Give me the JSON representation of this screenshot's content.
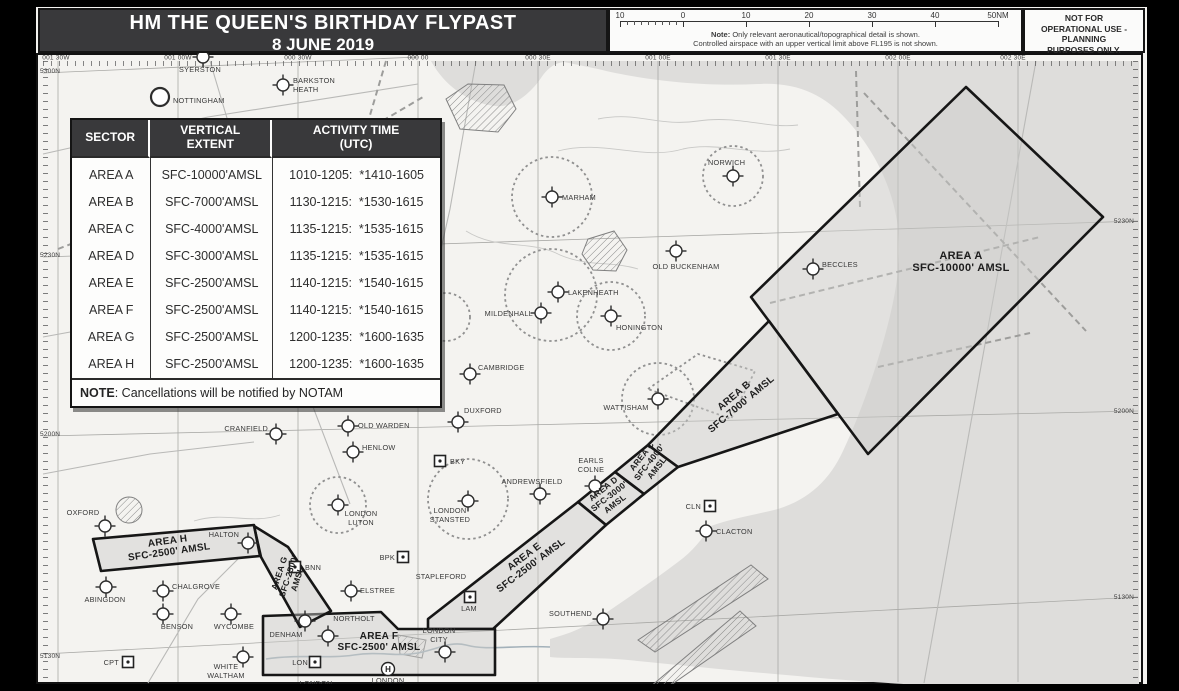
{
  "header": {
    "title_line1": "HM THE QUEEN'S BIRTHDAY FLYPAST",
    "title_line2": "8 JUNE 2019",
    "scale_ticks": [
      "10",
      "0",
      "10",
      "20",
      "30",
      "40",
      "50NM"
    ],
    "scale_note_label": "Note:",
    "scale_note_line1": "Only relevant aeronautical/topographical detail is shown.",
    "scale_note_line2": "Controlled airspace with an upper vertical limit above FL195 is not shown.",
    "disclaimer": "NOT FOR\nOPERATIONAL USE -\nPLANNING\nPURPOSES ONLY."
  },
  "activity_table": {
    "col_headers": [
      "SECTOR",
      "VERTICAL\nEXTENT",
      "ACTIVITY TIME\n(UTC)"
    ],
    "rows": [
      [
        "AREA A",
        "SFC-10000'AMSL",
        "1010-1205:  *1410-1605"
      ],
      [
        "AREA B",
        "SFC-7000'AMSL",
        "1130-1215:  *1530-1615"
      ],
      [
        "AREA C",
        "SFC-4000'AMSL",
        "1135-1215:  *1535-1615"
      ],
      [
        "AREA D",
        "SFC-3000'AMSL",
        "1135-1215:  *1535-1615"
      ],
      [
        "AREA E",
        "SFC-2500'AMSL",
        "1140-1215:  *1540-1615"
      ],
      [
        "AREA F",
        "SFC-2500'AMSL",
        "1140-1215:  *1540-1615"
      ],
      [
        "AREA G",
        "SFC-2500'AMSL",
        "1200-1235:  *1600-1635"
      ],
      [
        "AREA H",
        "SFC-2500'AMSL",
        "1200-1235:  *1600-1635"
      ]
    ],
    "note_bold": "NOTE",
    "note_rest": ": Cancellations will be notified by NOTAM"
  },
  "map": {
    "edge_labels": {
      "top": [
        {
          "text": "001 30W",
          "x": 58
        },
        {
          "text": "001 00W",
          "x": 180
        },
        {
          "text": "000 30W",
          "x": 300
        },
        {
          "text": "000 00",
          "x": 420
        },
        {
          "text": "000 30E",
          "x": 540
        },
        {
          "text": "001 00E",
          "x": 660
        },
        {
          "text": "001 30E",
          "x": 780
        },
        {
          "text": "002 00E",
          "x": 900
        },
        {
          "text": "002 30E",
          "x": 1015
        }
      ],
      "left": [
        {
          "text": "5300N",
          "y": 74
        },
        {
          "text": "5230N",
          "y": 258
        },
        {
          "text": "5200N",
          "y": 437
        },
        {
          "text": "5130N",
          "y": 659
        }
      ],
      "right": [
        {
          "text": "5230N",
          "y": 224
        },
        {
          "text": "5200N",
          "y": 414
        },
        {
          "text": "5130N",
          "y": 600
        }
      ]
    },
    "areas": [
      {
        "id": "area-a",
        "lines": [
          "AREA A",
          "SFC-10000' AMSL"
        ],
        "x": 963,
        "y": 260,
        "rot": 0,
        "fs": 11
      },
      {
        "id": "area-b",
        "lines": [
          "AREA B",
          "SFC-7000' AMSL"
        ],
        "x": 738,
        "y": 399,
        "rot": -40,
        "fs": 10
      },
      {
        "id": "area-c",
        "lines": [
          "AREA C",
          "SFC-4000'",
          "AMSL"
        ],
        "x": 646,
        "y": 459,
        "rot": -52,
        "fs": 8.5
      },
      {
        "id": "area-d",
        "lines": [
          "AREA D",
          "SFC-3000'",
          "AMSL"
        ],
        "x": 607,
        "y": 492,
        "rot": -38,
        "fs": 8.5
      },
      {
        "id": "area-e",
        "lines": [
          "AREA E",
          "SFC-2500' AMSL"
        ],
        "x": 528,
        "y": 560,
        "rot": -37,
        "fs": 10
      },
      {
        "id": "area-f",
        "lines": [
          "AREA F",
          "SFC-2500' AMSL"
        ],
        "x": 381,
        "y": 640,
        "rot": 0,
        "fs": 10
      },
      {
        "id": "area-g",
        "lines": [
          "AREA G",
          "SFC-2500'",
          "AMSL"
        ],
        "x": 284,
        "y": 575,
        "rot": -72,
        "fs": 8.5
      },
      {
        "id": "area-h",
        "lines": [
          "AREA H",
          "SFC-2500' AMSL"
        ],
        "x": 170,
        "y": 545,
        "rot": -8,
        "fs": 10
      }
    ],
    "places": [
      {
        "name": "SYERSTON",
        "sym": "airfield",
        "sx": 205,
        "sy": 58,
        "label": [
          "SYERSTON"
        ],
        "lx": 202,
        "ly": 73,
        "anchor": "middle"
      },
      {
        "name": "NOTTINGHAM",
        "sym": "city",
        "sx": 162,
        "sy": 98,
        "label": [
          "NOTTINGHAM"
        ],
        "lx": 175,
        "ly": 104,
        "anchor": "start"
      },
      {
        "name": "BARKSTON HEATH",
        "sym": "airfield",
        "sx": 285,
        "sy": 86,
        "label": [
          "BARKSTON",
          "HEATH"
        ],
        "lx": 295,
        "ly": 84,
        "anchor": "start"
      },
      {
        "name": "NORWICH",
        "sym": "airfield",
        "sx": 735,
        "sy": 177,
        "label": [
          "NORWICH"
        ],
        "lx": 710,
        "ly": 166,
        "anchor": "start"
      },
      {
        "name": "MARHAM",
        "sym": "airfield",
        "sx": 554,
        "sy": 198,
        "label": [
          "MARHAM"
        ],
        "lx": 564,
        "ly": 201,
        "anchor": "start"
      },
      {
        "name": "OLD BUCKENHAM",
        "sym": "airfield",
        "sx": 678,
        "sy": 252,
        "label": [
          "OLD BUCKENHAM"
        ],
        "lx": 688,
        "ly": 270,
        "anchor": "middle"
      },
      {
        "name": "BECCLES",
        "sym": "airfield",
        "sx": 815,
        "sy": 270,
        "label": [
          "BECCLES"
        ],
        "lx": 824,
        "ly": 268,
        "anchor": "start"
      },
      {
        "name": "LAKENHEATH",
        "sym": "airfield",
        "sx": 560,
        "sy": 293,
        "label": [
          "LAKENHEATH"
        ],
        "lx": 570,
        "ly": 296,
        "anchor": "start"
      },
      {
        "name": "MILDENHALL",
        "sym": "airfield",
        "sx": 543,
        "sy": 314,
        "label": [
          "MILDENHALL"
        ],
        "lx": 535,
        "ly": 317,
        "anchor": "end"
      },
      {
        "name": "HONINGTON",
        "sym": "airfield",
        "sx": 613,
        "sy": 317,
        "label": [
          "HONINGTON"
        ],
        "lx": 618,
        "ly": 331,
        "anchor": "start"
      },
      {
        "name": "CAMBRIDGE",
        "sym": "airfield",
        "sx": 472,
        "sy": 375,
        "label": [
          "CAMBRIDGE"
        ],
        "lx": 480,
        "ly": 371,
        "anchor": "start"
      },
      {
        "name": "DUXFORD",
        "sym": "airfield",
        "sx": 460,
        "sy": 423,
        "label": [
          "DUXFORD"
        ],
        "lx": 466,
        "ly": 414,
        "anchor": "start"
      },
      {
        "name": "OLD WARDEN",
        "sym": "airfield",
        "sx": 350,
        "sy": 427,
        "label": [
          "OLD WARDEN"
        ],
        "lx": 360,
        "ly": 429,
        "anchor": "start"
      },
      {
        "name": "CRANFIELD",
        "sym": "airfield",
        "sx": 278,
        "sy": 435,
        "label": [
          "CRANFIELD"
        ],
        "lx": 270,
        "ly": 432,
        "anchor": "end"
      },
      {
        "name": "HENLOW",
        "sym": "airfield",
        "sx": 355,
        "sy": 453,
        "label": [
          "HENLOW"
        ],
        "lx": 364,
        "ly": 451,
        "anchor": "start"
      },
      {
        "name": "BKY",
        "sym": "vor",
        "sx": 442,
        "sy": 462,
        "label": [
          "BKY"
        ],
        "lx": 452,
        "ly": 465,
        "anchor": "start"
      },
      {
        "name": "ANDREWSFIELD",
        "sym": "airfield",
        "sx": 542,
        "sy": 495,
        "label": [
          "ANDREWSFIELD"
        ],
        "lx": 534,
        "ly": 485,
        "anchor": "middle"
      },
      {
        "name": "EARLS COLNE",
        "sym": "airfield",
        "sx": 597,
        "sy": 487,
        "label": [
          "EARLS",
          "COLNE"
        ],
        "lx": 593,
        "ly": 464,
        "anchor": "middle"
      },
      {
        "name": "LONDON STANSTED",
        "sym": "airfield",
        "sx": 470,
        "sy": 502,
        "label": [
          "LONDON",
          "STANSTED"
        ],
        "lx": 452,
        "ly": 514,
        "anchor": "middle"
      },
      {
        "name": "LONDON LUTON",
        "sym": "airfield",
        "sx": 340,
        "sy": 506,
        "label": [
          "LONDON",
          "LUTON"
        ],
        "lx": 363,
        "ly": 517,
        "anchor": "middle"
      },
      {
        "name": "OXFORD",
        "sym": "airfield",
        "sx": 107,
        "sy": 527,
        "label": [
          "OXFORD"
        ],
        "lx": 85,
        "ly": 516,
        "anchor": "middle"
      },
      {
        "name": "HALTON",
        "sym": "airfield",
        "sx": 250,
        "sy": 544,
        "label": [
          "HALTON"
        ],
        "lx": 226,
        "ly": 538,
        "anchor": "middle"
      },
      {
        "name": "BNN",
        "sym": "vor",
        "sx": 297,
        "sy": 568,
        "label": [
          "BNN"
        ],
        "lx": 307,
        "ly": 571,
        "anchor": "start"
      },
      {
        "name": "ABINGDON",
        "sym": "airfield",
        "sx": 108,
        "sy": 588,
        "label": [
          "ABINGDON"
        ],
        "lx": 107,
        "ly": 603,
        "anchor": "middle"
      },
      {
        "name": "CHALGROVE",
        "sym": "airfield",
        "sx": 165,
        "sy": 592,
        "label": [
          "CHALGROVE"
        ],
        "lx": 174,
        "ly": 590,
        "anchor": "start"
      },
      {
        "name": "BENSON",
        "sym": "airfield",
        "sx": 165,
        "sy": 615,
        "label": [
          "BENSON"
        ],
        "lx": 179,
        "ly": 630,
        "anchor": "middle"
      },
      {
        "name": "WYCOMBE",
        "sym": "airfield",
        "sx": 233,
        "sy": 615,
        "label": [
          "WYCOMBE"
        ],
        "lx": 236,
        "ly": 630,
        "anchor": "middle"
      },
      {
        "name": "CPT",
        "sym": "vor",
        "sx": 130,
        "sy": 663,
        "label": [
          "CPT"
        ],
        "lx": 121,
        "ly": 666,
        "anchor": "end"
      },
      {
        "name": "WHITE WALTHAM",
        "sym": "airfield",
        "sx": 245,
        "sy": 658,
        "label": [
          "WHITE",
          "WALTHAM"
        ],
        "lx": 228,
        "ly": 670,
        "anchor": "middle"
      },
      {
        "name": "DENHAM",
        "sym": "airfield",
        "sx": 307,
        "sy": 622,
        "label": [
          "DENHAM"
        ],
        "lx": 288,
        "ly": 638,
        "anchor": "middle"
      },
      {
        "name": "NORTHOLT",
        "sym": "airfield",
        "sx": 330,
        "sy": 637,
        "label": [
          "NORTHOLT"
        ],
        "lx": 356,
        "ly": 622,
        "anchor": "middle"
      },
      {
        "name": "LON",
        "sym": "vor",
        "sx": 317,
        "sy": 663,
        "label": [
          "LON"
        ],
        "lx": 310,
        "ly": 666,
        "anchor": "end"
      },
      {
        "name": "LONDON CITY",
        "sym": "airfield",
        "sx": 447,
        "sy": 653,
        "label": [
          "LONDON",
          "CITY"
        ],
        "lx": 441,
        "ly": 634,
        "anchor": "middle"
      },
      {
        "name": "LONDON HELIPORT",
        "sym": "hel",
        "sx": 390,
        "sy": 670,
        "label": [
          "LONDON",
          "HELIPORT"
        ],
        "lx": 390,
        "ly": 684,
        "anchor": "middle"
      },
      {
        "name": "LONDON",
        "sym": "none",
        "sx": 318,
        "sy": 680,
        "label": [
          "LONDON"
        ],
        "lx": 318,
        "ly": 687,
        "anchor": "middle"
      },
      {
        "name": "ELSTREE",
        "sym": "airfield",
        "sx": 353,
        "sy": 592,
        "label": [
          "ELSTREE"
        ],
        "lx": 362,
        "ly": 594,
        "anchor": "start"
      },
      {
        "name": "BPK",
        "sym": "vor",
        "sx": 405,
        "sy": 558,
        "label": [
          "BPK"
        ],
        "lx": 397,
        "ly": 561,
        "anchor": "end"
      },
      {
        "name": "STAPLEFORD",
        "sym": "none",
        "sx": 443,
        "sy": 579,
        "label": [
          "STAPLEFORD"
        ],
        "lx": 443,
        "ly": 580,
        "anchor": "middle"
      },
      {
        "name": "LAM",
        "sym": "vor",
        "sx": 472,
        "sy": 598,
        "label": [
          "LAM"
        ],
        "lx": 471,
        "ly": 612,
        "anchor": "middle"
      },
      {
        "name": "SOUTHEND",
        "sym": "airfield",
        "sx": 605,
        "sy": 620,
        "label": [
          "SOUTHEND"
        ],
        "lx": 594,
        "ly": 617,
        "anchor": "end"
      },
      {
        "name": "CLN",
        "sym": "vor",
        "sx": 712,
        "sy": 507,
        "label": [
          "CLN"
        ],
        "lx": 703,
        "ly": 510,
        "anchor": "end"
      },
      {
        "name": "CLACTON",
        "sym": "airfield",
        "sx": 708,
        "sy": 532,
        "label": [
          "CLACTON"
        ],
        "lx": 718,
        "ly": 535,
        "anchor": "start"
      },
      {
        "name": "WATTISHAM",
        "sym": "airfield",
        "sx": 660,
        "sy": 400,
        "label": [
          "WATTISHAM"
        ],
        "lx": 628,
        "ly": 411,
        "anchor": "middle"
      }
    ]
  },
  "colors": {
    "header_dark": "#39393b",
    "sea": "#dedddb",
    "land": "#f4f3f0",
    "area_fill": "#cbcbc9",
    "area_stroke": "#161616"
  }
}
